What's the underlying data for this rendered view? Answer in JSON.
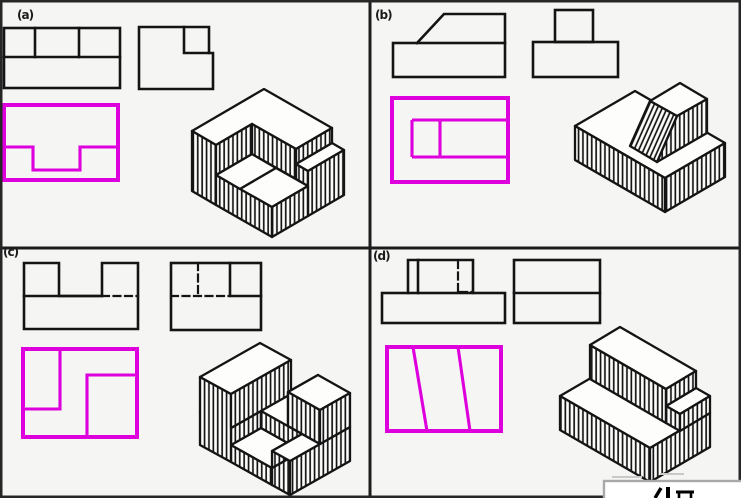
{
  "figure": {
    "description": "Engineering drawing exercise: four panels each showing two orthographic views, a magenta highlighted third view, and an isometric pictorial of a block.",
    "background": "#f5f5f4"
  },
  "colors": {
    "highlight_magenta": "#dd00dd",
    "line_black": "#141414",
    "divider_black": "#1c1c1c",
    "watermark_border": "#a9a9a9"
  },
  "panels": [
    {
      "label": "(a)"
    },
    {
      "label": "(b)"
    },
    {
      "label": "(c)"
    },
    {
      "label": "(d)"
    }
  ]
}
